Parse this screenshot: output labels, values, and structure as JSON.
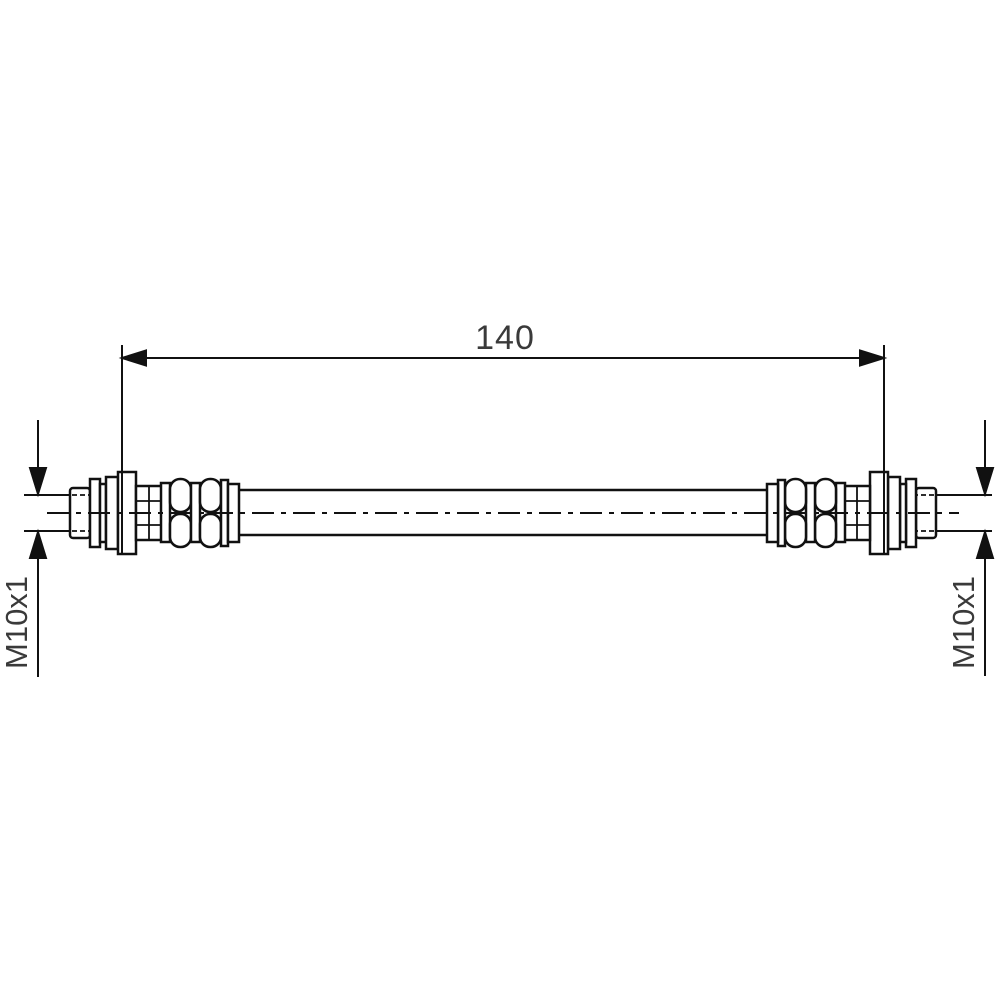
{
  "drawing": {
    "type": "technical-drawing-brake-hose",
    "background": "#ffffff",
    "line_color": "#111111",
    "text_color": "#3a3a3a",
    "dimension": {
      "label": "140",
      "meaning": "hose length between end fittings"
    },
    "thread_left": {
      "label": "M10x1"
    },
    "thread_right": {
      "label": "M10x1"
    }
  }
}
